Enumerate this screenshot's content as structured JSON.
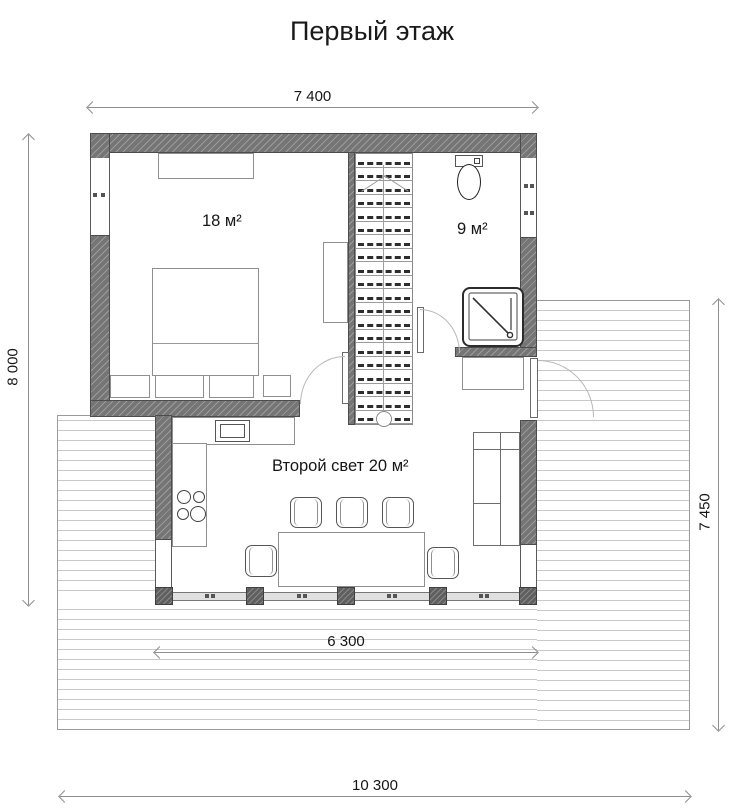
{
  "title": "Первый этаж",
  "dimensions": {
    "width_top": "7 400",
    "height_left": "8 000",
    "height_right": "7 450",
    "width_terrace": "6 300",
    "width_total": "10 300"
  },
  "rooms": {
    "bedroom": "18 м²",
    "bathroom": "9 м²",
    "living": "Второй свет 20 м²"
  },
  "colors": {
    "wall": "#757575",
    "dimension_line": "#8f8f8f",
    "deck_plank_line": "#c9c9c9",
    "text": "#181818"
  }
}
